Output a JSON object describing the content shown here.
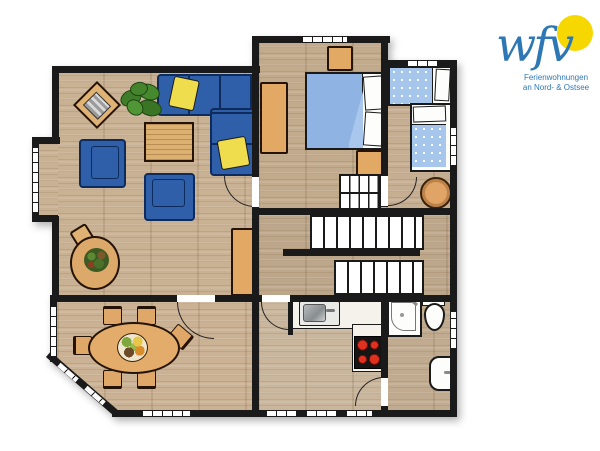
{
  "logo": {
    "monogram": "wfv",
    "tagline_line1": "Ferienwohnungen",
    "tagline_line2": "an Nord- & Ostsee"
  },
  "palette": {
    "wall": "#1a1a1a",
    "floor_wood": "#c6ae92",
    "sofa_blue": "#2f5fa8",
    "cushion_yellow": "#f0dd4e",
    "furniture_wood": "#e2a964",
    "double_bed_blue": "#8fb4e3",
    "kids_bed_blue": "#a6c6ec",
    "stove_red": "#d42f1e",
    "logo_blue": "#2e77b5",
    "sun_yellow": "#f6d800"
  },
  "floorplan": {
    "rooms": [
      {
        "id": "living-room",
        "furniture": [
          "corner-sofa",
          "yellow-cushions",
          "armchair",
          "armchair",
          "coffee-table",
          "potted-plant",
          "magazine-table",
          "jug-plant-table",
          "tall-cabinet"
        ]
      },
      {
        "id": "bedroom",
        "furniture": [
          "double-bed",
          "wardrobe",
          "nightstand",
          "nightstand",
          "crib"
        ]
      },
      {
        "id": "kids-room",
        "furniture": [
          "single-bed",
          "single-bed",
          "round-stool"
        ]
      },
      {
        "id": "hallway",
        "furniture": [
          "u-shaped-staircase"
        ]
      },
      {
        "id": "dining-room",
        "furniture": [
          "oval-dining-table",
          "six-chairs",
          "fruit-bowl"
        ]
      },
      {
        "id": "kitchen",
        "furniture": [
          "counter",
          "sink",
          "stove"
        ]
      },
      {
        "id": "bathroom",
        "furniture": [
          "shower",
          "toilet",
          "washbasin"
        ]
      }
    ]
  }
}
